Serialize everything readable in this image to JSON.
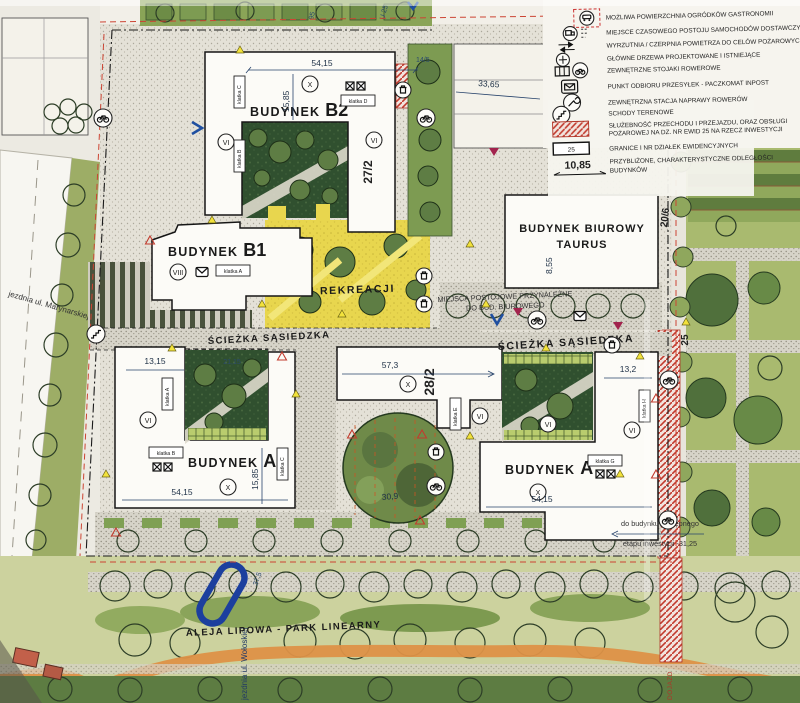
{
  "legend": {
    "rows": [
      {
        "icon": "dining-terrace-icon",
        "text": "MOŻLIWA POWIERZCHNIA OGRÓDKÓW GASTRONOMII"
      },
      {
        "icon": "delivery-parking-icon",
        "text": "MIEJSCE CZASOWEGO POSTOJU SAMOCHODÓW DOSTAWCZYCH"
      },
      {
        "icon": "air-intake-icon",
        "text": "WYRZUTNIA / CZERPNIA POWIETRZA DO CELÓW POŻAROWYCH"
      },
      {
        "icon": "tree-icon",
        "text": "GŁÓWNE DRZEWA PROJEKTOWANE I ISTNIEJĄCE"
      },
      {
        "icon": "bike-rack-icon",
        "text": "ZEWNĘTRZNE STOJAKI ROWEROWE"
      },
      {
        "icon": "parcel-locker-icon",
        "text": "PUNKT ODBIORU PRZESYŁEK - PACZKOMAT INPOST"
      },
      {
        "icon": "bike-repair-icon",
        "text": "ZEWNĘTRZNA STACJA NAPRAWY ROWERÓW"
      },
      {
        "icon": "stairs-icon",
        "text": "SCHODY TERENOWE"
      },
      {
        "icon": "easement-hatch",
        "line1": "SŁUŻEBNOŚĆ PRZECHODU I PRZEJAZDU, ORAZ OBSŁUGI",
        "line2": "POŻAROWEJ NA DZ. NR EWID 25 NA RZECZ INWESTYCJI"
      },
      {
        "icon": "plot-boundary",
        "box": "25",
        "text": "GRANICE I NR DZIAŁEK EWIDENCYJNYCH"
      },
      {
        "icon": "distance-sample",
        "sample": "10,85",
        "line1": "PRZYBLIŻONE, CHARAKTERYSTYCZNE ODLEGŁOŚCI",
        "line2": "BUDYNKÓW"
      }
    ]
  },
  "buildings": {
    "b2": {
      "prefix": "BUDYNEK",
      "name": "B2",
      "floors": "X",
      "wing_floors": "VI"
    },
    "b1": {
      "prefix": "BUDYNEK",
      "name": "B1",
      "floors": "VIII"
    },
    "a_left": {
      "prefix": "BUDYNEK",
      "name": "A",
      "floors": "X",
      "wing_floors": "VI"
    },
    "a_center": {
      "floors": "X",
      "wing_floors": "VI"
    },
    "a_right": {
      "prefix": "BUDYNEK",
      "name": "A",
      "floors": "X",
      "wing_floors": "VI"
    },
    "taurus": {
      "line1": "BUDYNEK BIUROWY",
      "line2": "TAURUS"
    }
  },
  "klatki": {
    "b2_b": "klatka B",
    "b2_c": "klatka C",
    "b2_d": "klatka D",
    "b1_a": "klatka A",
    "al_a": "klatka A",
    "al_b": "klatka B",
    "al_c": "klatka C",
    "c_e": "klatka E",
    "c_f": "klatka F",
    "ar_g": "klatka G",
    "ar_h": "klatka H"
  },
  "parcels": {
    "p27": "27/2",
    "p28": "28/2",
    "p20": "20/6",
    "p25": "25",
    "p14": "14/5"
  },
  "dimensions": {
    "b2_w": "54,15",
    "b2_d": "15,85",
    "d33": "33,65",
    "d13l": "13,15",
    "d21": "21,15",
    "d57": "57,3",
    "d13r": "13,2",
    "al_w": "54,15",
    "al_d": "15,85",
    "ar_w": "54,15",
    "d30": "30,9",
    "d8": "8,55",
    "d37": "37,5"
  },
  "areas": {
    "teren": "TEREN REKREACJI",
    "sciezka": "ŚCIEŻKA SĄSIEDZKA",
    "aleja": "ALEJA LIPOWA - PARK LINEARNY",
    "parking1": "MIEJSCA POSTOJOWE PRZYNALEŻNE",
    "parking2": "DO BUD. BIUROWEGO"
  },
  "streets": {
    "marynarska": "jezdnia ul. Marynarskiej",
    "woloska": "jezdnia ul. Wołoskiej"
  },
  "notes": {
    "next1": "do budynku następnego",
    "next2": "etapu inwestycji -31,25",
    "dojazd": "DOJAZD",
    "top95": "95",
    "topu25": "U 25"
  },
  "colors": {
    "easement_red": "#c23b2e",
    "recreation_yellow": "#e8d64e",
    "entrance_blue": "#1f4fa0",
    "path_orange": "#dd9147",
    "park_green": "#5d7c42"
  }
}
